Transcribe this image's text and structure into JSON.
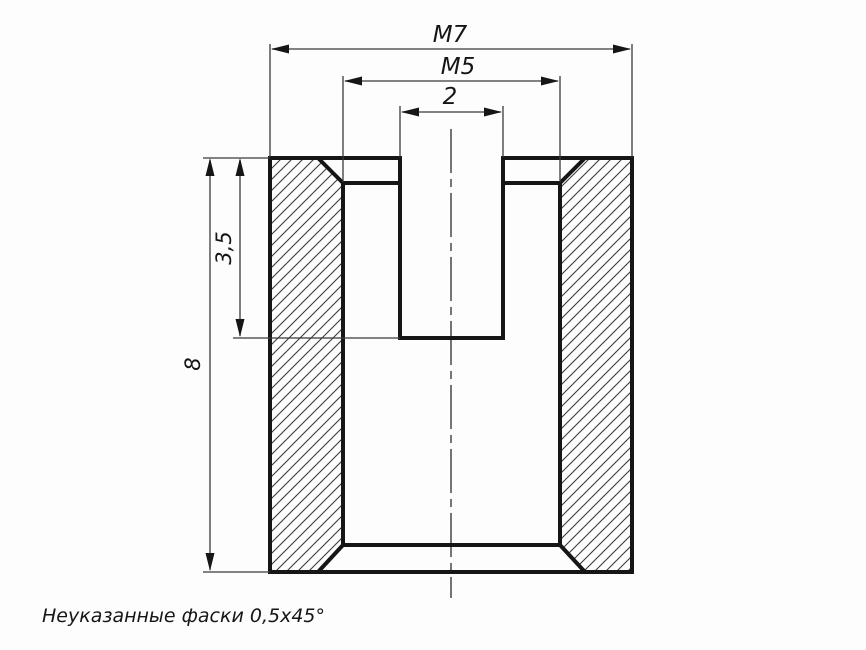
{
  "drawing": {
    "type": "section-view-threaded-bushing",
    "labels": {
      "outer_thread": "M7",
      "inner_thread": "M5",
      "hole_width": "2",
      "hole_depth": "3,5",
      "overall_height": "8"
    },
    "note": "Неуказанные фаски 0,5x45°",
    "colors": {
      "contour_line": "#161616",
      "thin_line": "#3a3a3a",
      "background": "#fdfdfd"
    }
  }
}
